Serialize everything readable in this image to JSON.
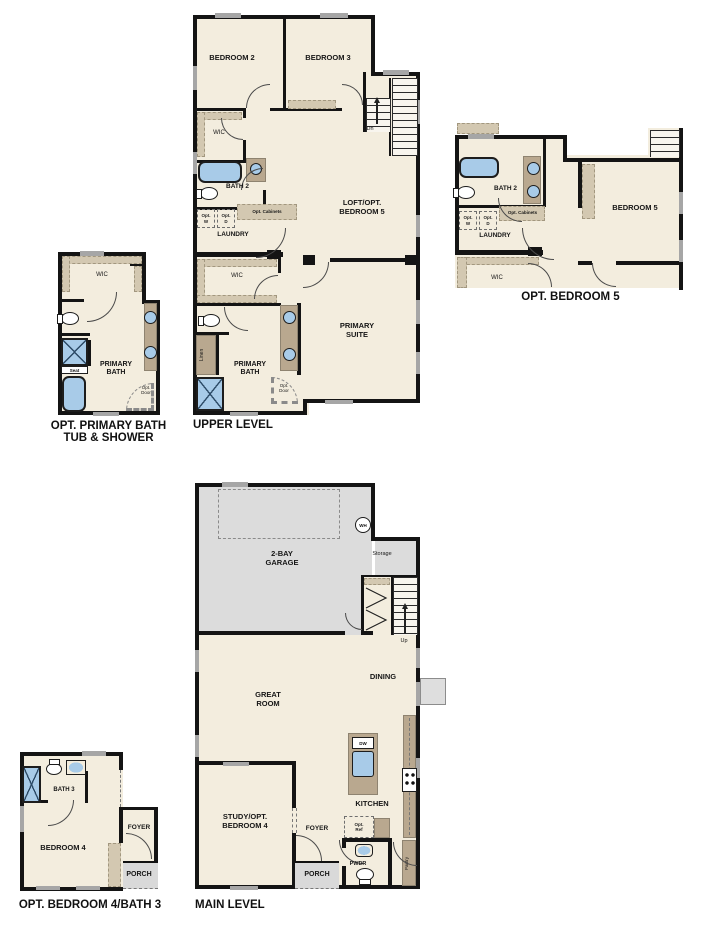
{
  "colors": {
    "floor": "#f3edde",
    "wall": "#141414",
    "cabinet": "#b9a88f",
    "cabinet2": "#d3c8b1",
    "garage": "#dcdcdc",
    "porch": "#d9d9d9",
    "window": "#a6a6a6",
    "fixture": "#a8cbe8"
  },
  "captions": {
    "upper_level": "UPPER LEVEL",
    "opt_bedroom5": "OPT. BEDROOM 5",
    "opt_primary_bath": "OPT. PRIMARY BATH\nTUB & SHOWER",
    "main_level": "MAIN LEVEL",
    "opt_bedroom4": "OPT. BEDROOM 4/BATH 3"
  },
  "labels": {
    "bedroom2": "BEDROOM 2",
    "bedroom3": "BEDROOM 3",
    "bedroom4": "BEDROOM 4",
    "bedroom5": "BEDROOM 5",
    "loft": "LOFT/OPT.\nBEDROOM 5",
    "primary_suite": "PRIMARY\nSUITE",
    "primary_bath": "PRIMARY\nBATH",
    "bath2": "BATH 2",
    "bath3": "BATH 3",
    "wic": "WIC",
    "laundry": "LAUNDRY",
    "linen": "Linen",
    "opt_w": "Opt.\nW",
    "opt_d": "Opt.\nD",
    "opt_cabinets": "Opt. Cabinets",
    "opt_door": "Opt.\nDoor",
    "opt_ref": "Opt.\nRef",
    "seat": "Seat",
    "dn": "Dn",
    "up": "Up",
    "wh": "WH",
    "storage": "Storage",
    "garage": "2-BAY\nGARAGE",
    "great_room": "GREAT\nROOM",
    "dining": "DINING",
    "kitchen": "KITCHEN",
    "dw": "DW",
    "study": "STUDY/OPT.\nBEDROOM 4",
    "foyer": "FOYER",
    "porch": "PORCH",
    "pwdr": "PWDR",
    "pantry": "Pantry"
  }
}
